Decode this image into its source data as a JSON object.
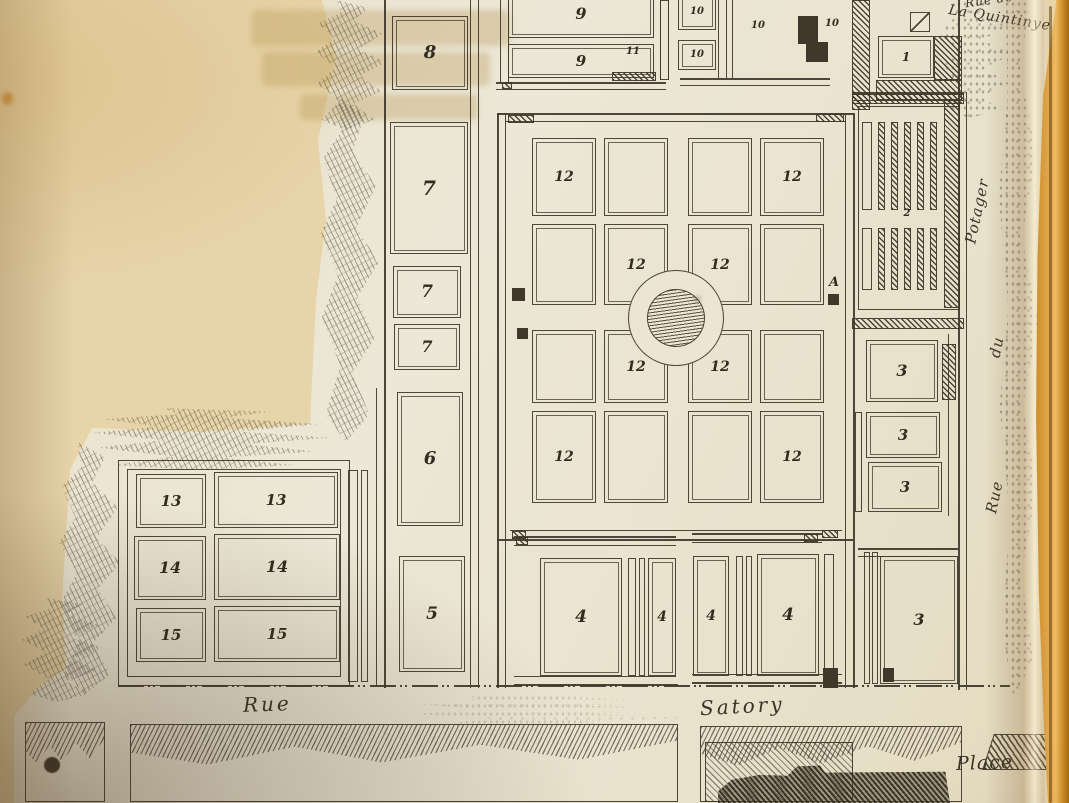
{
  "map": {
    "description_labels_note": "engraved plan numerals and street names visible in the image",
    "plots": [
      {
        "label": "8",
        "x": 392,
        "y": 16,
        "w": 76,
        "h": 74,
        "fs": 18
      },
      {
        "label": "7",
        "x": 390,
        "y": 122,
        "w": 78,
        "h": 132,
        "fs": 20
      },
      {
        "label": "7",
        "x": 393,
        "y": 266,
        "w": 68,
        "h": 52,
        "fs": 17
      },
      {
        "label": "7",
        "x": 394,
        "y": 324,
        "w": 66,
        "h": 46,
        "fs": 16
      },
      {
        "label": "6",
        "x": 397,
        "y": 392,
        "w": 66,
        "h": 134,
        "fs": 18
      },
      {
        "label": "5",
        "x": 399,
        "y": 556,
        "w": 66,
        "h": 116,
        "fs": 17
      },
      {
        "label": "9",
        "x": 508,
        "y": -10,
        "w": 146,
        "h": 48,
        "fs": 16
      },
      {
        "label": "9",
        "x": 508,
        "y": 44,
        "w": 146,
        "h": 34,
        "fs": 15
      },
      {
        "label": "11",
        "type": "label",
        "x": 620,
        "y": 44,
        "w": 26,
        "h": 16,
        "fs": 10
      },
      {
        "label": "10",
        "x": 678,
        "y": -6,
        "w": 38,
        "h": 36,
        "fs": 10
      },
      {
        "label": "10",
        "x": 678,
        "y": 40,
        "w": 38,
        "h": 30,
        "fs": 10
      },
      {
        "label": "10",
        "type": "label",
        "x": 744,
        "y": 18,
        "w": 28,
        "h": 16,
        "fs": 10
      },
      {
        "label": "10",
        "type": "label",
        "x": 818,
        "y": 16,
        "w": 28,
        "h": 16,
        "fs": 10
      },
      {
        "label": "1",
        "x": 878,
        "y": 36,
        "w": 56,
        "h": 42,
        "fs": 12
      },
      {
        "label": "2",
        "type": "label",
        "x": 894,
        "y": 206,
        "w": 26,
        "h": 15,
        "fs": 10
      },
      {
        "label": "12",
        "x": 532,
        "y": 138,
        "w": 64,
        "h": 78,
        "fs": 14
      },
      {
        "label": null,
        "x": 604,
        "y": 138,
        "w": 64,
        "h": 78
      },
      {
        "label": null,
        "x": 688,
        "y": 138,
        "w": 64,
        "h": 78
      },
      {
        "label": "12",
        "x": 760,
        "y": 138,
        "w": 64,
        "h": 78,
        "fs": 14
      },
      {
        "label": null,
        "x": 532,
        "y": 224,
        "w": 64,
        "h": 81
      },
      {
        "label": "12",
        "x": 604,
        "y": 224,
        "w": 64,
        "h": 81,
        "fs": 14
      },
      {
        "label": "12",
        "x": 688,
        "y": 224,
        "w": 64,
        "h": 81,
        "fs": 14
      },
      {
        "label": null,
        "x": 760,
        "y": 224,
        "w": 64,
        "h": 81
      },
      {
        "label": null,
        "x": 532,
        "y": 330,
        "w": 64,
        "h": 73
      },
      {
        "label": "12",
        "x": 604,
        "y": 330,
        "w": 64,
        "h": 73,
        "fs": 14
      },
      {
        "label": "12",
        "x": 688,
        "y": 330,
        "w": 64,
        "h": 73,
        "fs": 14
      },
      {
        "label": null,
        "x": 760,
        "y": 330,
        "w": 64,
        "h": 73
      },
      {
        "label": "12",
        "x": 532,
        "y": 411,
        "w": 64,
        "h": 92,
        "fs": 14
      },
      {
        "label": null,
        "x": 604,
        "y": 411,
        "w": 64,
        "h": 92
      },
      {
        "label": null,
        "x": 688,
        "y": 411,
        "w": 64,
        "h": 92
      },
      {
        "label": "12",
        "x": 760,
        "y": 411,
        "w": 64,
        "h": 92,
        "fs": 14
      },
      {
        "label": "3",
        "x": 866,
        "y": 340,
        "w": 72,
        "h": 62,
        "fs": 16
      },
      {
        "label": "3",
        "x": 866,
        "y": 412,
        "w": 74,
        "h": 46,
        "fs": 15
      },
      {
        "label": "3",
        "x": 868,
        "y": 462,
        "w": 74,
        "h": 50,
        "fs": 15
      },
      {
        "label": "3",
        "x": 880,
        "y": 556,
        "w": 78,
        "h": 128,
        "fs": 16
      },
      {
        "label": "13",
        "x": 136,
        "y": 474,
        "w": 70,
        "h": 54,
        "fs": 15
      },
      {
        "label": "13",
        "x": 214,
        "y": 472,
        "w": 124,
        "h": 56,
        "fs": 15
      },
      {
        "label": "14",
        "x": 134,
        "y": 536,
        "w": 72,
        "h": 64,
        "fs": 16
      },
      {
        "label": "14",
        "x": 214,
        "y": 534,
        "w": 126,
        "h": 66,
        "fs": 16
      },
      {
        "label": "15",
        "x": 136,
        "y": 608,
        "w": 70,
        "h": 54,
        "fs": 15
      },
      {
        "label": "15",
        "x": 214,
        "y": 606,
        "w": 126,
        "h": 56,
        "fs": 15
      },
      {
        "label": "4",
        "x": 540,
        "y": 558,
        "w": 82,
        "h": 118,
        "fs": 17
      },
      {
        "label": "4",
        "x": 648,
        "y": 558,
        "w": 28,
        "h": 118,
        "fs": 14
      },
      {
        "label": "4",
        "x": 693,
        "y": 556,
        "w": 36,
        "h": 120,
        "fs": 14
      },
      {
        "label": "4",
        "x": 757,
        "y": 554,
        "w": 62,
        "h": 122,
        "fs": 17
      },
      {
        "label": "A",
        "type": "label",
        "x": 824,
        "y": 274,
        "w": 20,
        "h": 16,
        "fs": 13
      }
    ],
    "streets": [
      {
        "text": "Rue",
        "x": 243,
        "y": 692,
        "fs": 20,
        "rot": -2,
        "ls": 3
      },
      {
        "text": "Satory",
        "x": 700,
        "y": 694,
        "fs": 20,
        "rot": -3,
        "ls": 3
      },
      {
        "text": "Place",
        "x": 956,
        "y": 752,
        "fs": 19,
        "rot": -2,
        "ls": 1
      },
      {
        "text": "Rue",
        "x": 978,
        "y": 488,
        "fs": 15,
        "rot": -78,
        "ls": 1
      },
      {
        "text": "du",
        "x": 986,
        "y": 338,
        "fs": 15,
        "rot": -78,
        "ls": 1
      },
      {
        "text": "Potager",
        "x": 944,
        "y": 202,
        "fs": 15,
        "rot": -78,
        "ls": 1
      },
      {
        "text": "Rue de",
        "x": 965,
        "y": -7,
        "fs": 12,
        "rot": -8,
        "ls": 1
      },
      {
        "text": "La Quintinye",
        "x": 948,
        "y": 10,
        "fs": 14,
        "rot": 9,
        "ls": 1
      }
    ]
  }
}
